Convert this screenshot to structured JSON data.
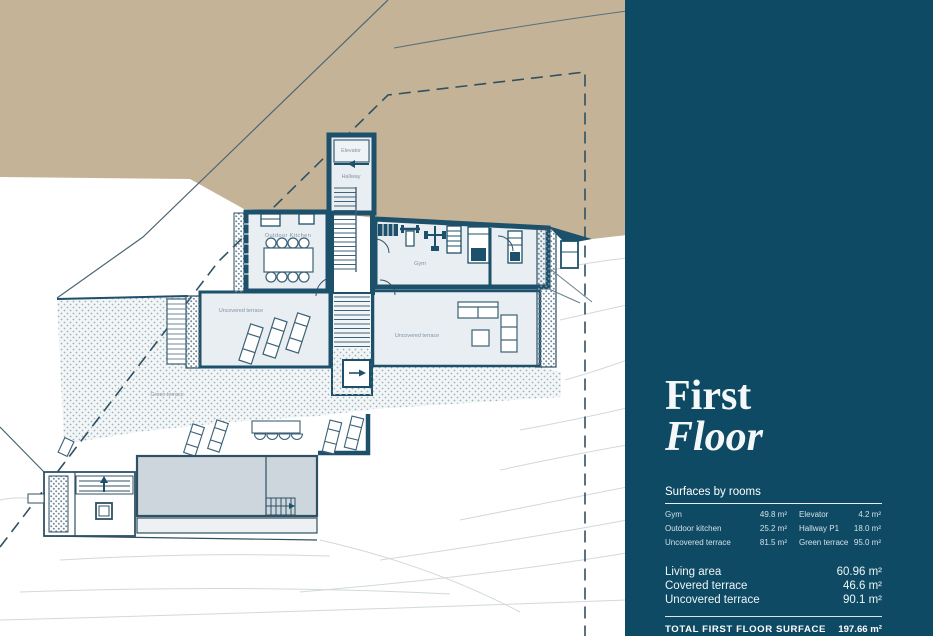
{
  "plan": {
    "labels": {
      "elevator": "Elevator",
      "hallway": "Hallway",
      "outdoor_kitchen": "Outdoor Kitchen",
      "gym": "Gym",
      "uncovered_terrace_left": "Uncovered terrace",
      "uncovered_terrace_right": "Uncovered terrace",
      "green_terrace": "Green terrace"
    }
  },
  "sidebar": {
    "title_line1": "First",
    "title_line2": "Floor",
    "surfaces_heading": "Surfaces by rooms",
    "rooms_rows": [
      {
        "c1": "Gym",
        "v1": "49.8 m²",
        "c2": "Elevator",
        "v2": "4.2 m²"
      },
      {
        "c1": "Outdoor kitchen",
        "v1": "25.2 m²",
        "c2": "Hallway P1",
        "v2": "18.0 m²"
      },
      {
        "c1": "Uncovered terrace",
        "v1": "81.5 m²",
        "c2": "Green terrace",
        "v2": "95.0 m²"
      }
    ],
    "summary_rows": [
      {
        "label": "Living area",
        "value": "60.96 m²"
      },
      {
        "label": "Covered terrace",
        "value": "46.6 m²"
      },
      {
        "label": "Uncovered terrace",
        "value": "90.1 m²"
      }
    ],
    "total_label": "TOTAL FIRST FLOOR SURFACE",
    "total_value": "197.66 m²"
  },
  "colors": {
    "terrain": "#c4b396",
    "sidebar_bg": "#0e4a63",
    "wall": "#1d506a",
    "room_fill": "#e9eef2",
    "pool_fill": "#ccd6dc"
  }
}
